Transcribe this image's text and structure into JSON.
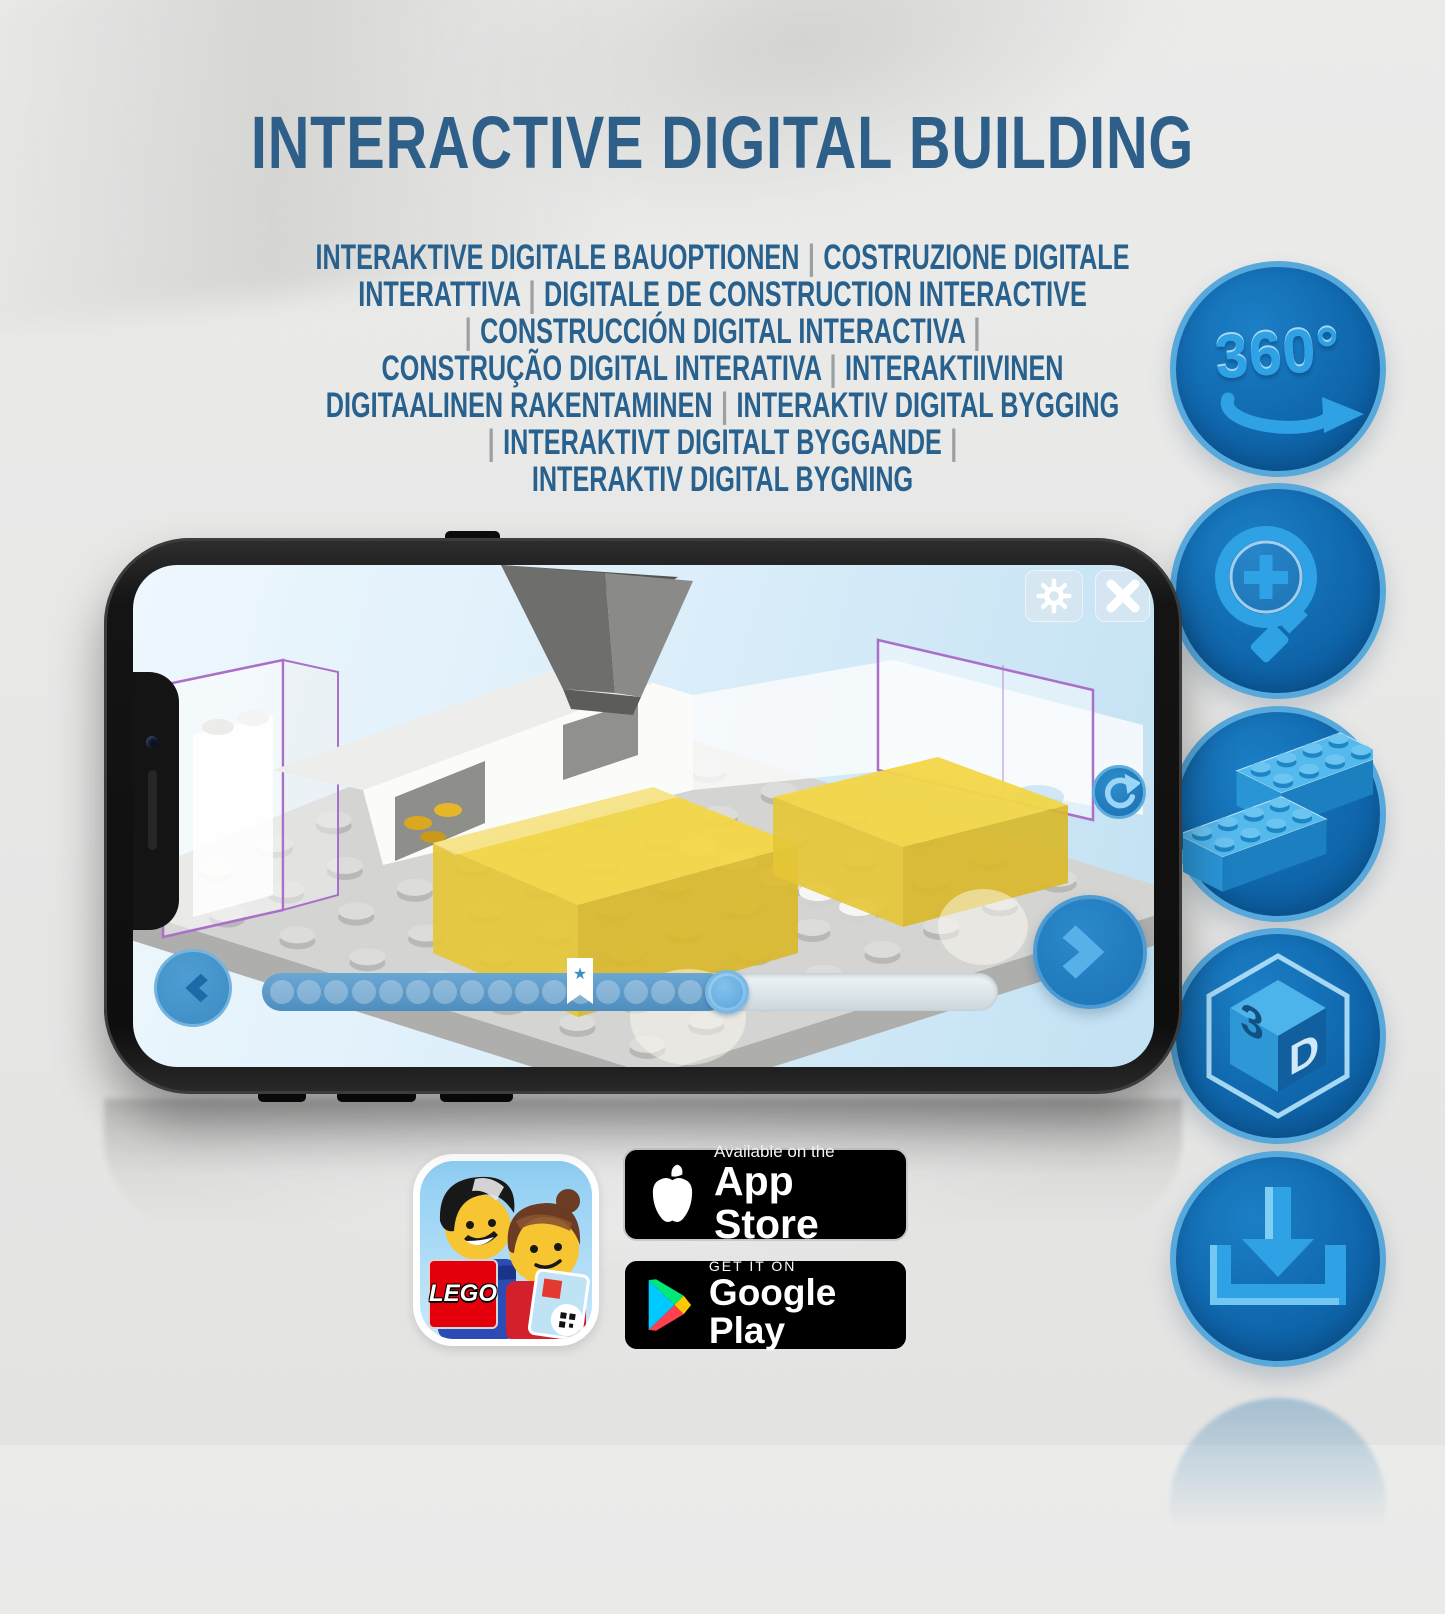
{
  "page": {
    "title": {
      "text": "INTERACTIVE DIGITAL BUILDING",
      "color": "#2d5f89"
    },
    "subtitle": {
      "color": "#28618d",
      "separator_color": "#9ba0a3",
      "lines": [
        "INTERAKTIVE DIGITALE BAUOPTIONEN | COSTRUZIONE DIGITALE",
        "INTERATTIVA | DIGITALE DE CONSTRUCTION INTERACTIVE",
        "| CONSTRUCCIÓN DIGITAL INTERACTIVA |",
        "CONSTRUÇÃO DIGITAL INTERATIVA | INTERAKTIIVINEN",
        "DIGITAALINEN RAKENTAMINEN | INTERAKTIV DIGITAL BYGGING",
        "| INTERAKTIVT DIGITALT BYGGANDE |",
        "INTERAKTIV DIGITAL BYGNING"
      ]
    }
  },
  "feature_icons": {
    "circle_color": "#0f66ab",
    "ring_color": "#57a9db",
    "glyph_color": "#2ea2e4",
    "items": [
      {
        "name": "rotate-360-icon",
        "label": "360°"
      },
      {
        "name": "zoom-in-icon"
      },
      {
        "name": "brick-icon"
      },
      {
        "name": "cube-3d-icon",
        "face_left": "3",
        "face_right": "D"
      },
      {
        "name": "download-icon"
      }
    ]
  },
  "phone": {
    "screen": {
      "toolbar": {
        "buttons": [
          "settings",
          "close"
        ]
      },
      "side_button": "reset-view",
      "nav": {
        "prev": "previous-step",
        "next": "next-step"
      },
      "progress": {
        "dot_count": 16,
        "fill_percent": 63,
        "bookmark_percent": 42,
        "bookmark_star": "★"
      }
    }
  },
  "badges": {
    "lego_app": {
      "wordmark": "LEGO"
    },
    "app_store": {
      "tagline": "Available on the",
      "store": "App Store"
    },
    "google_play": {
      "tagline": "GET IT ON",
      "store": "Google Play"
    }
  }
}
